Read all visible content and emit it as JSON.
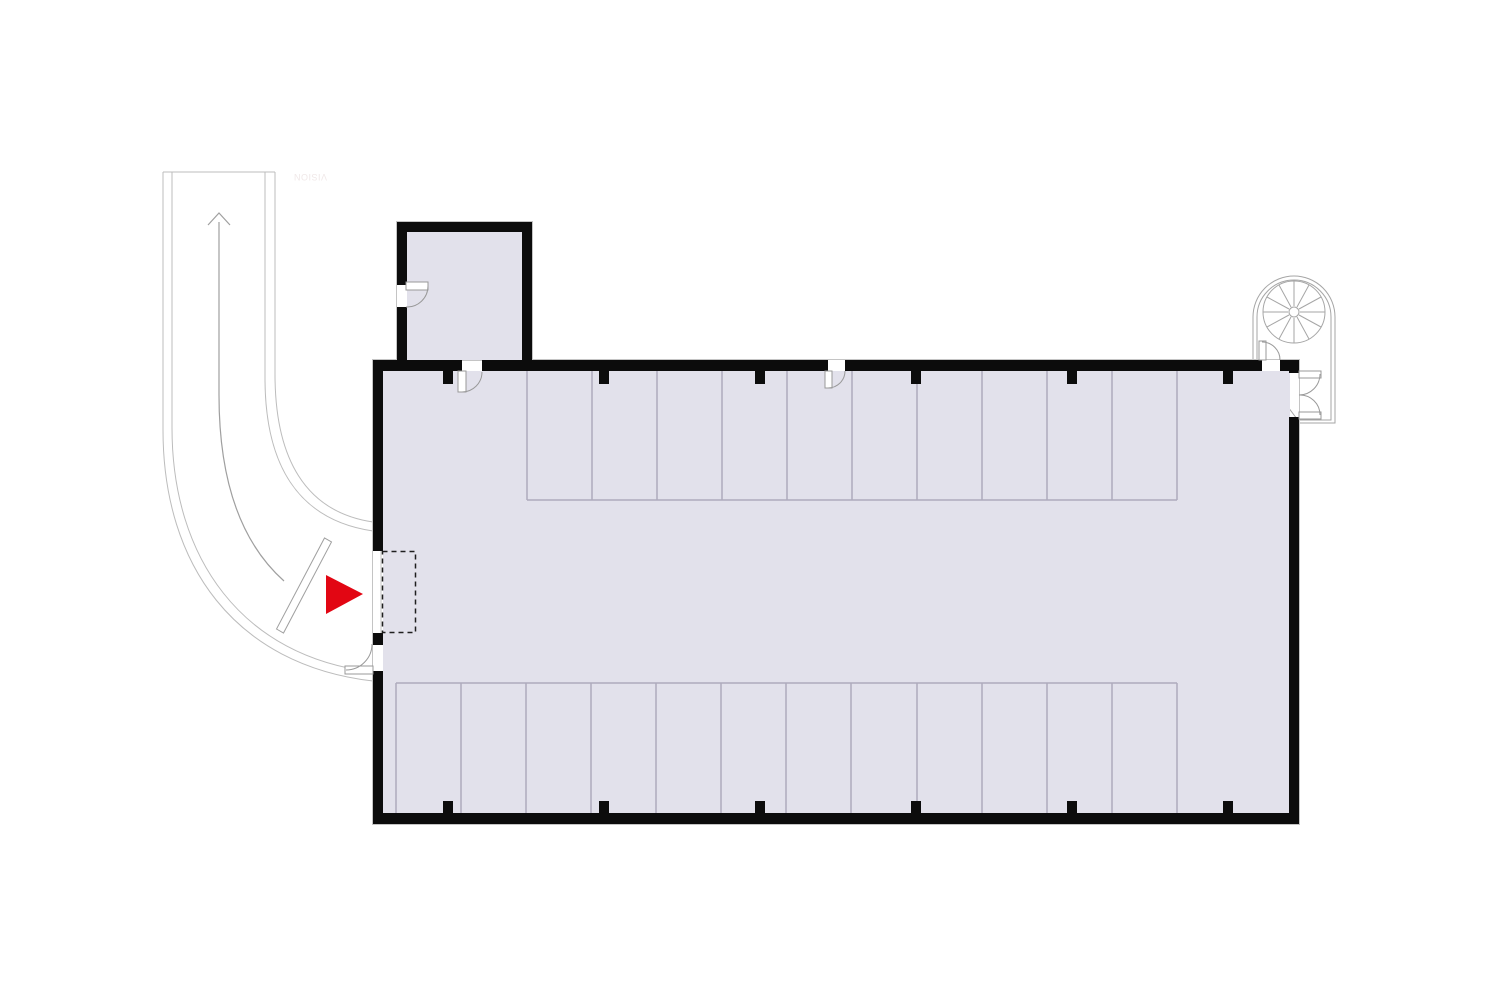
{
  "title": "Parking garage floor plan",
  "watermark": {
    "text": "VISION",
    "orientation": "rotated-180",
    "color": "#f0e8e8"
  },
  "colors": {
    "background": "#ffffff",
    "wall": "#0c0c0c",
    "floor": "#e2e1eb",
    "stall_line": "#aeabbc",
    "driveway_line": "#bcbcbc",
    "door_line": "#999999",
    "stair_line": "#a6a6a6",
    "dashed_zone": "#1f1f1f",
    "entrance_marker": "#e20613"
  },
  "plan_summary": {
    "type": "parking-garage-floor-plan",
    "top_row_stalls": 10,
    "bottom_row_stalls": 12,
    "column_ticks_top": 6,
    "column_ticks_bottom": 6,
    "swing_doors": 7,
    "features": [
      "curved entry driveway with up-direction arrow",
      "entry barrier arm",
      "dashed entrance zone inside garage opening",
      "red entrance marker triangle pointing right",
      "annex room at top-left",
      "spiral staircase enclosure at top-right"
    ]
  },
  "svg_elements": [
    {
      "tag": "path",
      "name": "driveway-top-edge",
      "interactable": false,
      "attrs": {
        "d": "M163,172 H275",
        "fill": "none",
        "stroke": "#bcbcbc",
        "stroke-width": "1"
      }
    },
    {
      "tag": "path",
      "name": "driveway-outer-edge-1",
      "interactable": false,
      "attrs": {
        "d": "M163,172 V430 C163,565 235,665 373,681",
        "fill": "none",
        "stroke": "#bcbcbc",
        "stroke-width": "1"
      }
    },
    {
      "tag": "path",
      "name": "driveway-outer-edge-2",
      "interactable": false,
      "attrs": {
        "d": "M172,172 V428 C172,558 242,657 373,672",
        "fill": "none",
        "stroke": "#bcbcbc",
        "stroke-width": "1"
      }
    },
    {
      "tag": "path",
      "name": "driveway-inner-edge-1",
      "interactable": false,
      "attrs": {
        "d": "M265,172 V378 C265,465 298,520 373,531",
        "fill": "none",
        "stroke": "#bcbcbc",
        "stroke-width": "1"
      }
    },
    {
      "tag": "path",
      "name": "driveway-inner-edge-2",
      "interactable": false,
      "attrs": {
        "d": "M275,172 V374 C275,458 305,512 373,522",
        "fill": "none",
        "stroke": "#bcbcbc",
        "stroke-width": "1"
      }
    },
    {
      "tag": "path",
      "name": "driveway-centerline",
      "interactable": false,
      "attrs": {
        "d": "M219,222 V395 C219,475 238,540 284,581",
        "fill": "none",
        "stroke": "#9f9f9f",
        "stroke-width": "1.2"
      }
    },
    {
      "tag": "path",
      "name": "driveway-direction-arrow-icon",
      "interactable": false,
      "attrs": {
        "d": "M208,225 L219,213 L230,225",
        "fill": "none",
        "stroke": "#9f9f9f",
        "stroke-width": "1.2"
      }
    },
    {
      "tag": "polygon",
      "name": "barrier-arm",
      "interactable": false,
      "attrs": {
        "points": "276.5,629 283.5,633 331.5,542 324.5,538",
        "fill": "#ffffff",
        "stroke": "#9f9f9f",
        "stroke-width": "1"
      }
    },
    {
      "tag": "path",
      "name": "spiral-stair-enclosure-outer",
      "interactable": false,
      "attrs": {
        "d": "M1253,360 V317 A41,41 0 0 1 1335,317 V423 H1300 Z",
        "fill": "#ffffff",
        "stroke": "#a6a6a6",
        "stroke-width": "1"
      }
    },
    {
      "tag": "path",
      "name": "spiral-stair-enclosure-inner",
      "interactable": false,
      "attrs": {
        "d": "M1257,360 V317 A37,37 0 0 1 1331,317 V420 H1300",
        "fill": "none",
        "stroke": "#a6a6a6",
        "stroke-width": "1"
      }
    },
    {
      "tag": "circle",
      "name": "spiral-stair-outline",
      "interactable": false,
      "attrs": {
        "cx": "1294",
        "cy": "312",
        "r": "31",
        "fill": "none",
        "stroke": "#a6a6a6",
        "stroke-width": "1"
      }
    },
    {
      "tag": "path",
      "name": "spiral-stair-treads",
      "interactable": false,
      "attrs": {
        "d": "M1300,312L1325,312M1299,315L1321,327M1297,317L1309,339M1294,318L1294,343M1291,317L1279,339M1289,315L1267,327M1288,312L1263,312M1289,309L1267,297M1291,307L1279,285M1294,306L1294,281M1297,307L1309,285M1299,309L1321,297",
        "fill": "none",
        "stroke": "#a6a6a6",
        "stroke-width": "1"
      }
    },
    {
      "tag": "circle",
      "name": "spiral-stair-newel",
      "interactable": false,
      "attrs": {
        "cx": "1294",
        "cy": "312",
        "r": "5",
        "fill": "#ffffff",
        "stroke": "#a6a6a6",
        "stroke-width": "1"
      }
    },
    {
      "tag": "rect",
      "name": "building-outline",
      "interactable": false,
      "attrs": {
        "x": "372.5",
        "y": "359.5",
        "width": "927",
        "height": "465",
        "fill": "none",
        "stroke": "#c4c4c4",
        "stroke-width": "1"
      }
    },
    {
      "tag": "rect",
      "name": "annex-outline",
      "interactable": false,
      "attrs": {
        "x": "396.5",
        "y": "221.5",
        "width": "136",
        "height": "139",
        "fill": "none",
        "stroke": "#c4c4c4",
        "stroke-width": "1"
      }
    },
    {
      "tag": "rect",
      "name": "annex-floor",
      "interactable": false,
      "attrs": {
        "x": "407",
        "y": "232",
        "width": "115",
        "height": "128",
        "fill": "#e2e1eb"
      }
    },
    {
      "tag": "rect",
      "name": "garage-floor",
      "interactable": false,
      "attrs": {
        "x": "383",
        "y": "371",
        "width": "907",
        "height": "443",
        "fill": "#e2e1eb"
      }
    },
    {
      "tag": "path",
      "name": "parking-stalls-top-row",
      "interactable": false,
      "attrs": {
        "d": "M527,371V500M592,371V500M657,371V500M722,371V500M787,371V500M852,371V500M917,371V500M982,371V500M1047,371V500M1112,371V500M1177,371V500M527,500H1177",
        "fill": "none",
        "stroke": "#aeabbc",
        "stroke-width": "1.5"
      }
    },
    {
      "tag": "path",
      "name": "parking-stalls-bottom-row",
      "interactable": false,
      "attrs": {
        "d": "M396,683V813M461,683V813M526,683V813M591,683V813M656,683V813M721,683V813M786,683V813M851,683V813M917,683V813M982,683V813M1047,683V813M1112,683V813M1177,683V813M396,683H1177",
        "fill": "none",
        "stroke": "#aeabbc",
        "stroke-width": "1.5"
      }
    },
    {
      "tag": "rect",
      "name": "wall-top-segment-1",
      "interactable": false,
      "attrs": {
        "x": "373",
        "y": "360",
        "width": "89",
        "height": "11",
        "fill": "#0c0c0c"
      }
    },
    {
      "tag": "rect",
      "name": "wall-top-segment-2",
      "interactable": false,
      "attrs": {
        "x": "482",
        "y": "360",
        "width": "346",
        "height": "11",
        "fill": "#0c0c0c"
      }
    },
    {
      "tag": "rect",
      "name": "wall-top-segment-3",
      "interactable": false,
      "attrs": {
        "x": "845",
        "y": "360",
        "width": "417",
        "height": "11",
        "fill": "#0c0c0c"
      }
    },
    {
      "tag": "rect",
      "name": "wall-top-segment-4",
      "interactable": false,
      "attrs": {
        "x": "1280",
        "y": "360",
        "width": "19",
        "height": "11",
        "fill": "#0c0c0c"
      }
    },
    {
      "tag": "rect",
      "name": "wall-bottom",
      "interactable": false,
      "attrs": {
        "x": "373",
        "y": "813",
        "width": "926",
        "height": "11",
        "fill": "#0c0c0c"
      }
    },
    {
      "tag": "rect",
      "name": "wall-left-segment-1",
      "interactable": false,
      "attrs": {
        "x": "373",
        "y": "360",
        "width": "10",
        "height": "191",
        "fill": "#0c0c0c"
      }
    },
    {
      "tag": "rect",
      "name": "wall-left-segment-2",
      "interactable": false,
      "attrs": {
        "x": "373",
        "y": "633",
        "width": "10",
        "height": "12",
        "fill": "#0c0c0c"
      }
    },
    {
      "tag": "rect",
      "name": "wall-left-segment-3",
      "interactable": false,
      "attrs": {
        "x": "373",
        "y": "671",
        "width": "10",
        "height": "142",
        "fill": "#0c0c0c"
      }
    },
    {
      "tag": "rect",
      "name": "wall-right-segment-1",
      "interactable": false,
      "attrs": {
        "x": "1289",
        "y": "360",
        "width": "10",
        "height": "13",
        "fill": "#0c0c0c"
      }
    },
    {
      "tag": "rect",
      "name": "wall-right-segment-2",
      "interactable": false,
      "attrs": {
        "x": "1289",
        "y": "417",
        "width": "10",
        "height": "396",
        "fill": "#0c0c0c"
      }
    },
    {
      "tag": "rect",
      "name": "annex-wall-top",
      "interactable": false,
      "attrs": {
        "x": "397",
        "y": "222",
        "width": "135",
        "height": "10",
        "fill": "#0c0c0c"
      }
    },
    {
      "tag": "rect",
      "name": "annex-wall-left-segment-1",
      "interactable": false,
      "attrs": {
        "x": "397",
        "y": "222",
        "width": "10",
        "height": "63",
        "fill": "#0c0c0c"
      }
    },
    {
      "tag": "rect",
      "name": "annex-wall-left-segment-2",
      "interactable": false,
      "attrs": {
        "x": "397",
        "y": "307",
        "width": "10",
        "height": "53",
        "fill": "#0c0c0c"
      }
    },
    {
      "tag": "rect",
      "name": "annex-wall-right",
      "interactable": false,
      "attrs": {
        "x": "522",
        "y": "222",
        "width": "10",
        "height": "138",
        "fill": "#0c0c0c"
      }
    },
    {
      "tag": "path",
      "name": "column-ticks",
      "interactable": false,
      "attrs": {
        "d": "M443,371h10v13h-10zM599,371h10v13h-10zM755,371h10v13h-10zM911,371h10v13h-10zM1067,371h10v13h-10zM1223,371h10v13h-10zM443,801h10v13h-10zM599,801h10v13h-10zM755,801h10v13h-10zM911,801h10v13h-10zM1067,801h10v13h-10zM1223,801h10v13h-10z",
        "fill": "#0c0c0c"
      }
    },
    {
      "tag": "line",
      "name": "entrance-threshold",
      "interactable": false,
      "attrs": {
        "x1": "381",
        "y1": "551",
        "x2": "381",
        "y2": "633",
        "stroke": "#c4c4c4",
        "stroke-width": "1"
      }
    },
    {
      "tag": "rect",
      "name": "annex-door-leaf",
      "interactable": false,
      "attrs": {
        "x": "406",
        "y": "282",
        "width": "22",
        "height": "8",
        "fill": "#ffffff",
        "stroke": "#999999",
        "stroke-width": "1"
      }
    },
    {
      "tag": "path",
      "name": "annex-door-arc",
      "interactable": false,
      "attrs": {
        "d": "M428,286 A21,21 0 0 1 406,307",
        "fill": "none",
        "stroke": "#999999",
        "stroke-width": "1"
      }
    },
    {
      "tag": "rect",
      "name": "annex-garage-door-leaf",
      "interactable": false,
      "attrs": {
        "x": "458",
        "y": "371",
        "width": "8",
        "height": "21",
        "fill": "#ffffff",
        "stroke": "#999999",
        "stroke-width": "1"
      }
    },
    {
      "tag": "path",
      "name": "annex-garage-door-arc",
      "interactable": false,
      "attrs": {
        "d": "M462,392 A20,20 0 0 0 482,372",
        "fill": "none",
        "stroke": "#999999",
        "stroke-width": "1"
      }
    },
    {
      "tag": "rect",
      "name": "top-wall-door-leaf",
      "interactable": false,
      "attrs": {
        "x": "825",
        "y": "371",
        "width": "7",
        "height": "17",
        "fill": "#ffffff",
        "stroke": "#999999",
        "stroke-width": "1"
      }
    },
    {
      "tag": "path",
      "name": "top-wall-door-arc",
      "interactable": false,
      "attrs": {
        "d": "M828,388 A17,17 0 0 0 845,371",
        "fill": "none",
        "stroke": "#999999",
        "stroke-width": "1"
      }
    },
    {
      "tag": "rect",
      "name": "stair-access-door-leaf",
      "interactable": false,
      "attrs": {
        "x": "1259",
        "y": "341",
        "width": "7",
        "height": "19",
        "fill": "#ffffff",
        "stroke": "#999999",
        "stroke-width": "1"
      }
    },
    {
      "tag": "path",
      "name": "stair-access-door-arc",
      "interactable": false,
      "attrs": {
        "d": "M1262,342 A18,18 0 0 1 1280,360",
        "fill": "none",
        "stroke": "#999999",
        "stroke-width": "1"
      }
    },
    {
      "tag": "rect",
      "name": "side-exit-door-leaf",
      "interactable": false,
      "attrs": {
        "x": "345",
        "y": "666",
        "width": "28",
        "height": "8",
        "fill": "#ffffff",
        "stroke": "#999999",
        "stroke-width": "1"
      }
    },
    {
      "tag": "path",
      "name": "side-exit-door-arc",
      "interactable": false,
      "attrs": {
        "d": "M346,670 A26,26 0 0 0 372,644",
        "fill": "none",
        "stroke": "#999999",
        "stroke-width": "1"
      }
    },
    {
      "tag": "rect",
      "name": "stair-double-door-top-leaf",
      "interactable": false,
      "attrs": {
        "x": "1299",
        "y": "371",
        "width": "22",
        "height": "7",
        "fill": "#ffffff",
        "stroke": "#999999",
        "stroke-width": "1"
      }
    },
    {
      "tag": "path",
      "name": "stair-double-door-top-arc",
      "interactable": false,
      "attrs": {
        "d": "M1320,374 A21,21 0 0 1 1299,395",
        "fill": "none",
        "stroke": "#999999",
        "stroke-width": "1"
      }
    },
    {
      "tag": "rect",
      "name": "stair-double-door-bottom-leaf",
      "interactable": false,
      "attrs": {
        "x": "1299",
        "y": "412",
        "width": "22",
        "height": "7",
        "fill": "#ffffff",
        "stroke": "#999999",
        "stroke-width": "1"
      }
    },
    {
      "tag": "path",
      "name": "stair-double-door-bottom-arc",
      "interactable": false,
      "attrs": {
        "d": "M1320,415 A20,20 0 0 0 1299,395",
        "fill": "none",
        "stroke": "#999999",
        "stroke-width": "1"
      }
    },
    {
      "tag": "rect",
      "name": "entrance-dashed-zone",
      "interactable": false,
      "attrs": {
        "x": "382.5",
        "y": "551.5",
        "width": "33",
        "height": "81",
        "fill": "none",
        "stroke": "#1f1f1f",
        "stroke-width": "1.5",
        "stroke-dasharray": "5,4"
      }
    },
    {
      "tag": "path",
      "name": "entrance-marker",
      "interactable": true,
      "attrs": {
        "d": "M326,575 L326,614 L363,594 Z",
        "fill": "#e20613"
      }
    }
  ]
}
